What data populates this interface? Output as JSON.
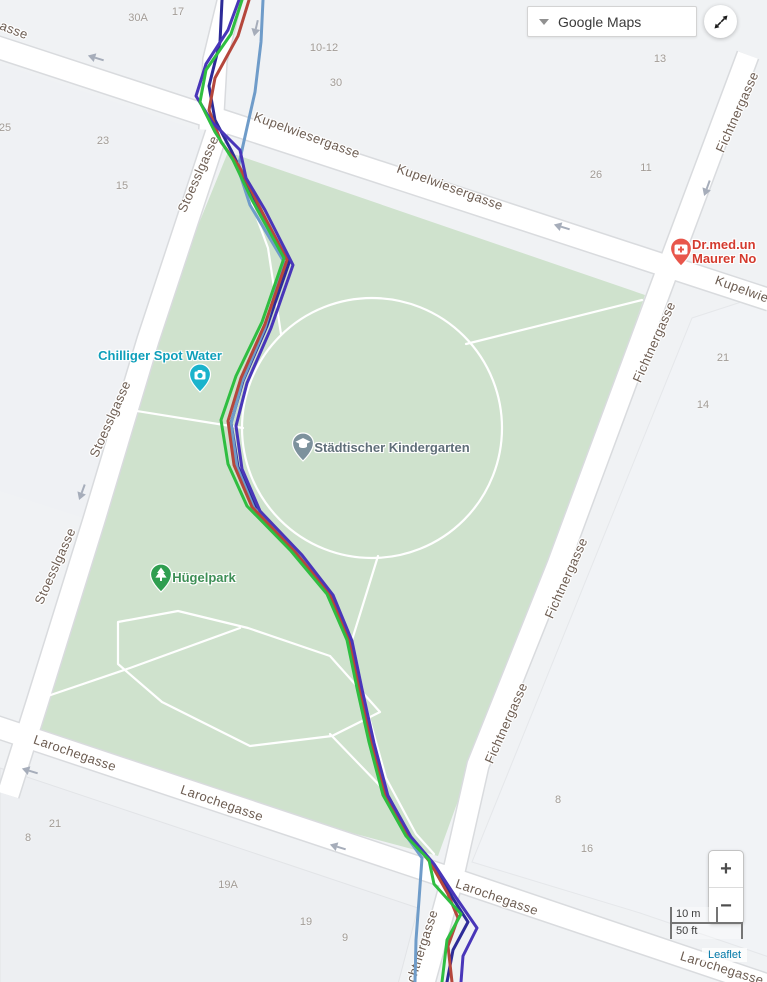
{
  "controls": {
    "basemap_label": "Google Maps",
    "zoom_in": "+",
    "zoom_out": "−",
    "scale_metric": "10 m",
    "scale_imperial": "50 ft",
    "attribution": "Leaflet"
  },
  "map": {
    "colors": {
      "background": "#f0f2f4",
      "park": "#cfe2cd",
      "road_fill": "#ffffff",
      "road_casing": "#d9dbde",
      "path": "#ffffff",
      "street_label": "#6d5d52",
      "house_number": "#a29c96",
      "arrow": "#a6adba"
    },
    "parcels": [
      {
        "points": [
          [
            0,
            768
          ],
          [
            418,
            908
          ],
          [
            398,
            984
          ],
          [
            0,
            984
          ]
        ],
        "fill": "#edeff2",
        "stroke": "#e2e4e7"
      },
      {
        "points": [
          [
            692,
            318
          ],
          [
            769,
            293
          ],
          [
            769,
            957
          ],
          [
            640,
            913
          ],
          [
            472,
            862
          ]
        ],
        "fill": "#f1f3f6",
        "stroke": "#e5e7ea"
      },
      {
        "points": [
          [
            -4,
            62
          ],
          [
            204,
            132
          ],
          [
            96,
            522
          ],
          [
            -4,
            490
          ]
        ],
        "fill": "#eff1f4",
        "stroke": "none"
      }
    ],
    "park": {
      "points": [
        [
          228,
          152
        ],
        [
          645,
          295
        ],
        [
          553,
          558
        ],
        [
          472,
          762
        ],
        [
          438,
          856
        ],
        [
          20,
          744
        ],
        [
          47,
          688
        ],
        [
          101,
          514
        ],
        [
          153,
          336
        ]
      ]
    },
    "roads": [
      {
        "id": "kupelwiesergasse",
        "points": [
          [
            -6,
            46
          ],
          [
            770,
            300
          ]
        ],
        "width": 21
      },
      {
        "id": "access-road-north",
        "points": [
          [
            231,
            -6
          ],
          [
            215,
            60
          ],
          [
            211,
            130
          ]
        ],
        "width": 23
      },
      {
        "id": "stoesslgasse",
        "points": [
          [
            219,
            125
          ],
          [
            148,
            340
          ],
          [
            94,
            520
          ],
          [
            38,
            700
          ],
          [
            8,
            795
          ]
        ],
        "width": 21
      },
      {
        "id": "fichtnergasse",
        "points": [
          [
            748,
            55
          ],
          [
            660,
            290
          ],
          [
            558,
            565
          ],
          [
            478,
            765
          ],
          [
            452,
            880
          ],
          [
            423,
            986
          ]
        ],
        "width": 21
      },
      {
        "id": "larochegasse",
        "points": [
          [
            -6,
            726
          ],
          [
            450,
            878
          ],
          [
            770,
            986
          ]
        ],
        "width": 21
      }
    ],
    "park_paths": [
      {
        "shape": "circle",
        "cx": 372,
        "cy": 428,
        "r": 130
      },
      {
        "shape": "line",
        "points": [
          [
            466,
            344
          ],
          [
            642,
            300
          ]
        ]
      },
      {
        "shape": "line",
        "points": [
          [
            118,
            408
          ],
          [
            243,
            428
          ]
        ]
      },
      {
        "shape": "line",
        "points": [
          [
            234,
            156
          ],
          [
            268,
            248
          ],
          [
            281,
            334
          ]
        ]
      },
      {
        "shape": "loop",
        "points": [
          [
            118,
            622
          ],
          [
            178,
            611
          ],
          [
            248,
            628
          ],
          [
            330,
            656
          ],
          [
            380,
            712
          ],
          [
            332,
            736
          ],
          [
            250,
            746
          ],
          [
            162,
            702
          ],
          [
            118,
            664
          ]
        ]
      },
      {
        "shape": "line",
        "points": [
          [
            36,
            700
          ],
          [
            130,
            668
          ],
          [
            240,
            628
          ]
        ]
      },
      {
        "shape": "line",
        "points": [
          [
            378,
            556
          ],
          [
            352,
            640
          ],
          [
            366,
            706
          ],
          [
            386,
            778
          ],
          [
            416,
            834
          ],
          [
            434,
            854
          ]
        ]
      },
      {
        "shape": "line",
        "points": [
          [
            330,
            734
          ],
          [
            386,
            792
          ]
        ]
      }
    ],
    "arrows": [
      {
        "x": 96,
        "y": 58,
        "angle": 197
      },
      {
        "x": 256,
        "y": 28,
        "angle": 103
      },
      {
        "x": 562,
        "y": 227,
        "angle": 197
      },
      {
        "x": 82,
        "y": 492,
        "angle": 110
      },
      {
        "x": 707,
        "y": 188,
        "angle": 110
      },
      {
        "x": 338,
        "y": 847,
        "angle": 197
      },
      {
        "x": 30,
        "y": 771,
        "angle": 197
      }
    ],
    "street_labels": [
      {
        "text": "asse",
        "x": 14,
        "y": 30,
        "angle": 21
      },
      {
        "text": "Kupelwiesergasse",
        "x": 307,
        "y": 135,
        "angle": 20
      },
      {
        "text": "Kupelwiesergasse",
        "x": 450,
        "y": 187,
        "angle": 20
      },
      {
        "text": "Kupelwie",
        "x": 742,
        "y": 289,
        "angle": 20
      },
      {
        "text": "Stoesslgasse",
        "x": 198,
        "y": 174,
        "angle": -66
      },
      {
        "text": "Stoesslgasse",
        "x": 110,
        "y": 419,
        "angle": -66
      },
      {
        "text": "Stoesslgasse",
        "x": 55,
        "y": 566,
        "angle": -66
      },
      {
        "text": "Fichtnergasse",
        "x": 737,
        "y": 112,
        "angle": -66
      },
      {
        "text": "Fichtnergasse",
        "x": 654,
        "y": 342,
        "angle": -66
      },
      {
        "text": "Fichtnergasse",
        "x": 566,
        "y": 578,
        "angle": -66
      },
      {
        "text": "Fichtnergasse",
        "x": 506,
        "y": 723,
        "angle": -66
      },
      {
        "text": "chtnergasse",
        "x": 422,
        "y": 946,
        "angle": -72
      },
      {
        "text": "Larochegasse",
        "x": 75,
        "y": 753,
        "angle": 19
      },
      {
        "text": "Larochegasse",
        "x": 222,
        "y": 803,
        "angle": 19
      },
      {
        "text": "Larochegasse",
        "x": 497,
        "y": 897,
        "angle": 19
      },
      {
        "text": "Larochegasse",
        "x": 722,
        "y": 968,
        "angle": 17
      }
    ],
    "house_numbers": [
      {
        "text": "30A",
        "x": 138,
        "y": 18
      },
      {
        "text": "17",
        "x": 178,
        "y": 12
      },
      {
        "text": "10-12",
        "x": 324,
        "y": 48
      },
      {
        "text": "30",
        "x": 336,
        "y": 83
      },
      {
        "text": "13",
        "x": 660,
        "y": 59
      },
      {
        "text": "25",
        "x": 5,
        "y": 128
      },
      {
        "text": "23",
        "x": 103,
        "y": 141
      },
      {
        "text": "15",
        "x": 122,
        "y": 186
      },
      {
        "text": "26",
        "x": 596,
        "y": 175
      },
      {
        "text": "11",
        "x": 646,
        "y": 168
      },
      {
        "text": "21",
        "x": 723,
        "y": 358
      },
      {
        "text": "14",
        "x": 703,
        "y": 405
      },
      {
        "text": "8",
        "x": 558,
        "y": 800
      },
      {
        "text": "16",
        "x": 587,
        "y": 849
      },
      {
        "text": "21",
        "x": 55,
        "y": 824
      },
      {
        "text": "8",
        "x": 28,
        "y": 838
      },
      {
        "text": "19A",
        "x": 228,
        "y": 885
      },
      {
        "text": "19",
        "x": 306,
        "y": 922
      },
      {
        "text": "9",
        "x": 345,
        "y": 938
      }
    ],
    "pois": [
      {
        "id": "chilliger-spot-water",
        "lines": [
          "Chilliger Spot Water"
        ],
        "label_color": "#0e9fba",
        "label_x": 160,
        "label_y": 356,
        "align": "center",
        "pin_color": "#1ab3cc",
        "icon": "camera-icon",
        "pin_x": 200,
        "pin_y": 393
      },
      {
        "id": "staedtischer-kindergarten",
        "lines": [
          "Städtischer Kindergarten"
        ],
        "label_color": "#5f6e78",
        "label_x": 392,
        "label_y": 448,
        "align": "center",
        "pin_color": "#7d929d",
        "icon": "school-icon",
        "pin_x": 303,
        "pin_y": 462
      },
      {
        "id": "huegelpark",
        "lines": [
          "Hügelpark"
        ],
        "label_color": "#3d8e55",
        "label_x": 204,
        "label_y": 578,
        "align": "center",
        "pin_color": "#2f9e50",
        "icon": "tree-icon",
        "pin_x": 161,
        "pin_y": 593
      },
      {
        "id": "dr-med-maurer",
        "lines": [
          "Dr.med.un",
          "Maurer No"
        ],
        "label_color": "#d43a2e",
        "label_x": 692,
        "label_y": 252,
        "align": "left",
        "pin_color": "#e8564b",
        "icon": "hospital-icon",
        "pin_x": 681,
        "pin_y": 267
      }
    ],
    "tracks": [
      {
        "id": "run-navy",
        "color": "#2d2b98",
        "points": [
          [
            222,
            0
          ],
          [
            220,
            42
          ],
          [
            209,
            86
          ],
          [
            215,
            120
          ],
          [
            232,
            152
          ],
          [
            255,
            200
          ],
          [
            289,
            263
          ],
          [
            267,
            326
          ],
          [
            243,
            381
          ],
          [
            231,
            423
          ],
          [
            238,
            467
          ],
          [
            256,
            509
          ],
          [
            299,
            553
          ],
          [
            331,
            593
          ],
          [
            351,
            639
          ],
          [
            361,
            687
          ],
          [
            373,
            741
          ],
          [
            387,
            794
          ],
          [
            410,
            836
          ],
          [
            432,
            862
          ],
          [
            452,
            897
          ],
          [
            468,
            922
          ],
          [
            453,
            950
          ],
          [
            447,
            982
          ]
        ]
      },
      {
        "id": "run-steel",
        "color": "#6f9cc9",
        "points": [
          [
            263,
            0
          ],
          [
            261,
            42
          ],
          [
            255,
            92
          ],
          [
            246,
            132
          ],
          [
            238,
            168
          ],
          [
            250,
            205
          ],
          [
            284,
            262
          ],
          [
            265,
            328
          ],
          [
            242,
            382
          ],
          [
            231,
            424
          ],
          [
            237,
            467
          ],
          [
            254,
            508
          ],
          [
            296,
            551
          ],
          [
            328,
            592
          ],
          [
            348,
            638
          ],
          [
            358,
            686
          ],
          [
            370,
            740
          ],
          [
            383,
            793
          ],
          [
            405,
            834
          ],
          [
            422,
            858
          ],
          [
            419,
            900
          ],
          [
            416,
            940
          ],
          [
            415,
            982
          ]
        ]
      },
      {
        "id": "run-red",
        "color": "#b5473c",
        "points": [
          [
            249,
            0
          ],
          [
            238,
            36
          ],
          [
            215,
            78
          ],
          [
            209,
            110
          ],
          [
            221,
            142
          ],
          [
            239,
            166
          ],
          [
            258,
            204
          ],
          [
            287,
            260
          ],
          [
            265,
            324
          ],
          [
            241,
            378
          ],
          [
            228,
            421
          ],
          [
            234,
            465
          ],
          [
            252,
            507
          ],
          [
            295,
            552
          ],
          [
            329,
            593
          ],
          [
            349,
            639
          ],
          [
            359,
            687
          ],
          [
            371,
            741
          ],
          [
            385,
            794
          ],
          [
            408,
            835
          ],
          [
            430,
            862
          ],
          [
            448,
            894
          ],
          [
            458,
            918
          ],
          [
            448,
            946
          ],
          [
            452,
            982
          ]
        ]
      },
      {
        "id": "run-violet",
        "color": "#4936b9",
        "points": [
          [
            239,
            0
          ],
          [
            228,
            30
          ],
          [
            206,
            64
          ],
          [
            196,
            96
          ],
          [
            212,
            122
          ],
          [
            240,
            150
          ],
          [
            246,
            178
          ],
          [
            265,
            210
          ],
          [
            293,
            265
          ],
          [
            271,
            328
          ],
          [
            247,
            383
          ],
          [
            236,
            426
          ],
          [
            242,
            469
          ],
          [
            260,
            511
          ],
          [
            302,
            555
          ],
          [
            333,
            595
          ],
          [
            352,
            641
          ],
          [
            362,
            689
          ],
          [
            374,
            743
          ],
          [
            388,
            796
          ],
          [
            411,
            837
          ],
          [
            434,
            864
          ],
          [
            455,
            896
          ],
          [
            477,
            928
          ],
          [
            463,
            956
          ],
          [
            461,
            982
          ]
        ]
      },
      {
        "id": "run-green",
        "color": "#2fbe41",
        "points": [
          [
            242,
            0
          ],
          [
            231,
            34
          ],
          [
            206,
            70
          ],
          [
            200,
            102
          ],
          [
            215,
            132
          ],
          [
            233,
            160
          ],
          [
            252,
            200
          ],
          [
            284,
            258
          ],
          [
            262,
            322
          ],
          [
            236,
            376
          ],
          [
            221,
            420
          ],
          [
            228,
            464
          ],
          [
            247,
            506
          ],
          [
            291,
            551
          ],
          [
            327,
            594
          ],
          [
            347,
            640
          ],
          [
            357,
            688
          ],
          [
            369,
            742
          ],
          [
            383,
            795
          ],
          [
            406,
            836
          ],
          [
            429,
            860
          ],
          [
            434,
            884
          ],
          [
            461,
            914
          ],
          [
            447,
            940
          ],
          [
            442,
            982
          ]
        ]
      }
    ]
  }
}
